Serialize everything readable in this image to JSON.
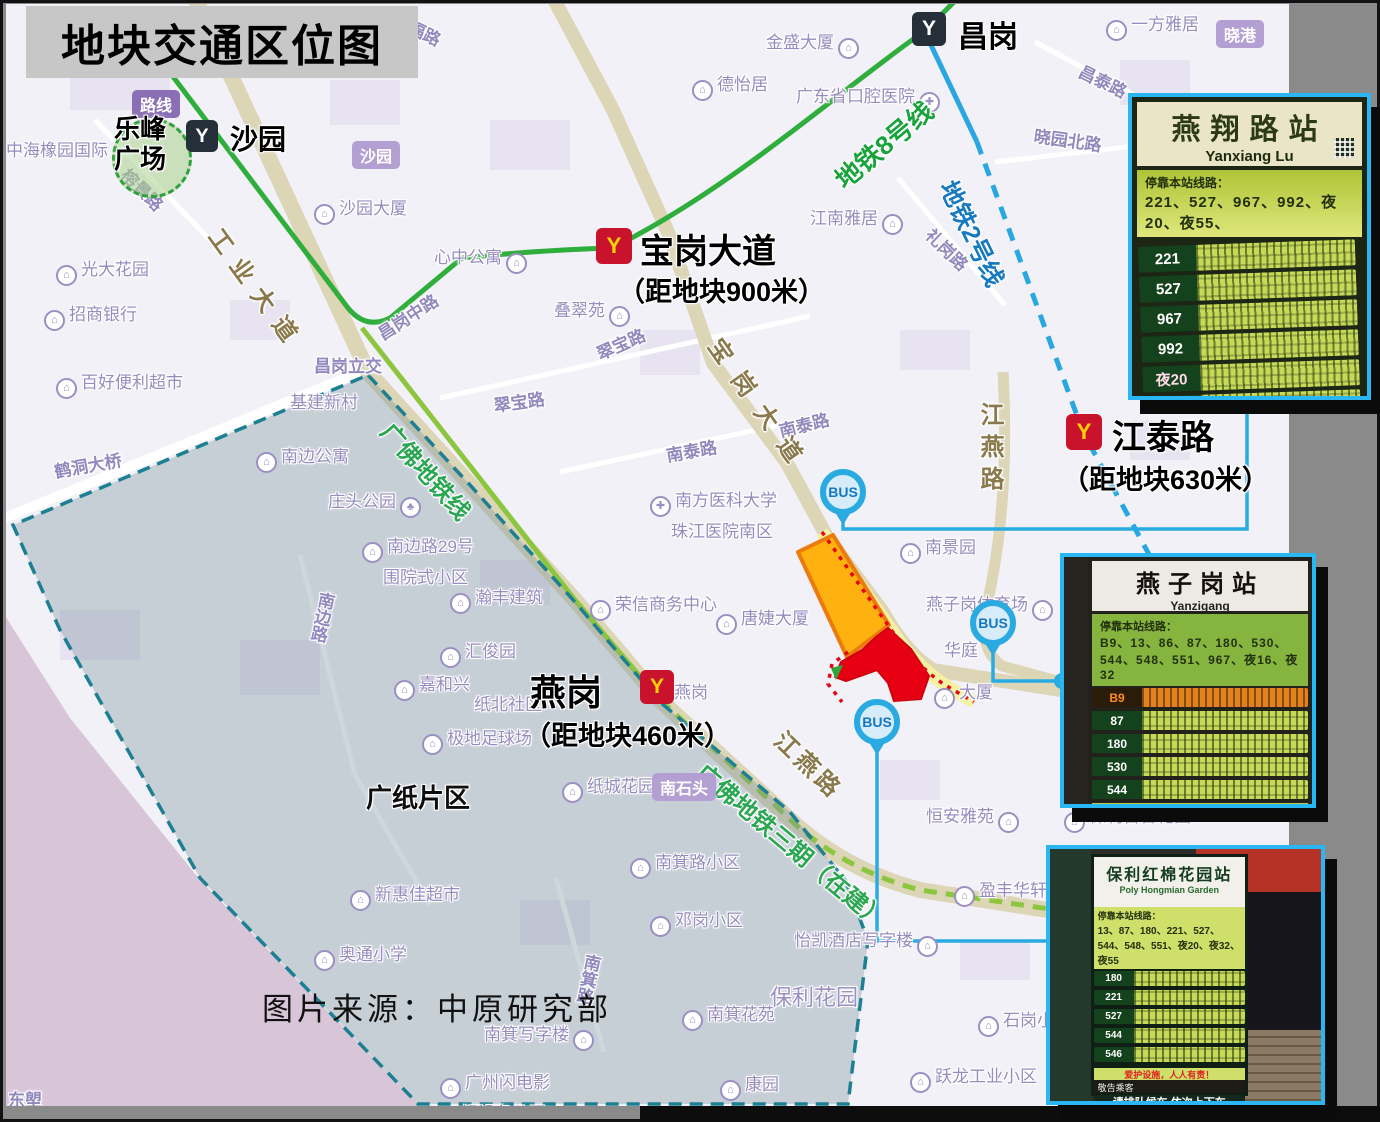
{
  "title": "地块交通区位图",
  "source_note": "图片来源：中原研究部",
  "bus_label": "BUS",
  "area_label": "广纸片区",
  "plaza": {
    "line1": "乐峰",
    "line2": "广场"
  },
  "colors": {
    "accent_blue": "#29abe2",
    "metro_line8_green": "#2fae3c",
    "guangfo_green": "#8cc63e",
    "metro_line2_blue": "#2aa7e0",
    "plot_orange": "#ffb20f",
    "plot_red": "#e60012",
    "region_border_teal": "#1d7f92",
    "road_tan": "#dcd5b6",
    "title_bg": "#c7c7c7"
  },
  "stations": [
    {
      "name": "沙园",
      "style": "dark",
      "x": 186,
      "y": 120,
      "size": 32,
      "label_dx": 44,
      "label_dy": -2,
      "label_size": 28
    },
    {
      "name": "昌岗",
      "style": "dark",
      "x": 912,
      "y": 12,
      "size": 34,
      "label_dx": 46,
      "label_dy": 0,
      "label_size": 30
    },
    {
      "name": "宝岗大道",
      "style": "red",
      "x": 596,
      "y": 228,
      "size": 36,
      "label_dx": 44,
      "label_dy": -4,
      "label_size": 34,
      "dist": "（距地块900米）",
      "dist_dx": 22,
      "dist_dy": 42
    },
    {
      "name": "江泰路",
      "style": "red",
      "x": 1066,
      "y": 414,
      "size": 36,
      "label_dx": 46,
      "label_dy": -4,
      "label_size": 34,
      "dist": "（距地块630米）",
      "dist_dx": -4,
      "dist_dy": 44
    },
    {
      "name": "燕岗",
      "style": "red",
      "x": 640,
      "y": 670,
      "size": 34,
      "label_dx": -110,
      "label_dy": -6,
      "label_size": 36,
      "dist": "（距地块460米）",
      "dist_dx": -116,
      "dist_dy": 44
    }
  ],
  "metro_line_labels": [
    {
      "t": "地铁8号线",
      "x": 826,
      "y": 168,
      "r": -40,
      "cls": "mgreen"
    },
    {
      "t": "地铁2号线",
      "x": 964,
      "y": 174,
      "r": 64,
      "cls": "mblue"
    },
    {
      "t": "广佛地铁线",
      "x": 400,
      "y": 414,
      "r": 48,
      "cls": "mgf"
    },
    {
      "t": "广佛地铁三期（在建）",
      "x": 712,
      "y": 754,
      "r": 40,
      "cls": "mgf"
    }
  ],
  "road_labels": [
    {
      "t": "工业大道",
      "x": 230,
      "y": 220,
      "r": 54,
      "ls": 12
    },
    {
      "t": "宝岗大道",
      "x": 730,
      "y": 330,
      "r": 55,
      "ls": 16
    },
    {
      "t": "江燕路",
      "x": 972,
      "y": 402,
      "v": 1,
      "ls": 8
    },
    {
      "t": "江燕路",
      "x": 792,
      "y": 722,
      "r": 44,
      "ls": 4
    }
  ],
  "street_labels": [
    {
      "t": "绣福路",
      "x": 400,
      "y": 6,
      "r": 26
    },
    {
      "t": "榕景路",
      "x": 134,
      "y": 162,
      "r": 45
    },
    {
      "t": "昌岗中路",
      "x": 372,
      "y": 324,
      "r": -33
    },
    {
      "t": "昌岗立交",
      "x": 314,
      "y": 352,
      "r": 0
    },
    {
      "t": "翠宝路",
      "x": 592,
      "y": 342,
      "r": -24
    },
    {
      "t": "翠宝路",
      "x": 492,
      "y": 392,
      "r": -8
    },
    {
      "t": "南泰路",
      "x": 664,
      "y": 442,
      "r": -10
    },
    {
      "t": "南泰路",
      "x": 776,
      "y": 418,
      "r": -14
    },
    {
      "t": "昌泰路",
      "x": 1086,
      "y": 58,
      "r": 26
    },
    {
      "t": "晓园北路",
      "x": 1036,
      "y": 122,
      "r": 8
    },
    {
      "t": "礼岗路",
      "x": 938,
      "y": 222,
      "r": 44
    },
    {
      "t": "鹤洞大桥",
      "x": 52,
      "y": 458,
      "r": -10
    },
    {
      "t": "南边路",
      "x": 314,
      "y": 592,
      "v": 1,
      "r": 12
    },
    {
      "t": "南箕路",
      "x": 580,
      "y": 954,
      "v": 1,
      "r": 12
    },
    {
      "t": "东塱",
      "x": 8,
      "y": 1086,
      "r": 0
    }
  ],
  "boxed_labels": [
    {
      "t": "路线",
      "x": 132,
      "y": 90,
      "dark": 1
    },
    {
      "t": "沙园",
      "x": 352,
      "y": 141
    },
    {
      "t": "晓港",
      "x": 1216,
      "y": 20
    },
    {
      "t": "南石头",
      "x": 652,
      "y": 773
    }
  ],
  "poi_labels": [
    {
      "t": "中海橡园国际",
      "x": 6,
      "y": 136
    },
    {
      "t": "光大花园",
      "x": 52,
      "y": 255,
      "i": "b",
      "s": "l"
    },
    {
      "t": "招商银行",
      "x": 40,
      "y": 300,
      "i": "b",
      "s": "l"
    },
    {
      "t": "百好便利超市",
      "x": 52,
      "y": 368,
      "i": "b",
      "s": "l"
    },
    {
      "t": "沙园大厦",
      "x": 310,
      "y": 194,
      "i": "b",
      "s": "l"
    },
    {
      "t": "心中公寓",
      "x": 434,
      "y": 243,
      "i": "b",
      "s": "r"
    },
    {
      "t": "德怡居",
      "x": 688,
      "y": 70,
      "i": "b",
      "s": "l"
    },
    {
      "t": "金盛大厦",
      "x": 766,
      "y": 28,
      "i": "b",
      "s": "r"
    },
    {
      "t": "一方雅居",
      "x": 1102,
      "y": 10,
      "i": "b",
      "s": "l"
    },
    {
      "t": "广东省口腔医院",
      "x": 796,
      "y": 82,
      "i": "h",
      "s": "r"
    },
    {
      "t": "江南雅居",
      "x": 810,
      "y": 204,
      "i": "b",
      "s": "r"
    },
    {
      "t": "叠翠苑",
      "x": 554,
      "y": 296,
      "i": "b",
      "s": "r"
    },
    {
      "t": "基建新村",
      "x": 290,
      "y": 388
    },
    {
      "t": "南边公寓",
      "x": 252,
      "y": 442,
      "i": "b",
      "s": "l"
    },
    {
      "t": "庄头公园",
      "x": 328,
      "y": 487,
      "i": "p",
      "s": "r"
    },
    {
      "t": "南边路29号",
      "t2": "围院式小区",
      "x": 358,
      "y": 532,
      "i": "b",
      "s": "l"
    },
    {
      "t": "瀚丰建筑",
      "x": 446,
      "y": 583,
      "i": "b",
      "s": "l"
    },
    {
      "t": "汇俊园",
      "x": 436,
      "y": 637,
      "i": "b",
      "s": "l"
    },
    {
      "t": "嘉和兴",
      "x": 390,
      "y": 670,
      "i": "b",
      "s": "l"
    },
    {
      "t": "极地足球场",
      "x": 418,
      "y": 724,
      "i": "b",
      "s": "l"
    },
    {
      "t": "纸北社区",
      "x": 474,
      "y": 690
    },
    {
      "t": "纸城花园",
      "x": 558,
      "y": 772,
      "i": "b",
      "s": "l"
    },
    {
      "t": "南箕路小区",
      "x": 626,
      "y": 848,
      "i": "b",
      "s": "l"
    },
    {
      "t": "邓岗小区",
      "x": 646,
      "y": 906,
      "i": "b",
      "s": "l"
    },
    {
      "t": "新惠佳超市",
      "x": 346,
      "y": 880,
      "i": "b",
      "s": "l"
    },
    {
      "t": "奥通小学",
      "x": 310,
      "y": 940,
      "i": "b",
      "s": "l"
    },
    {
      "t": "南箕写字楼",
      "x": 484,
      "y": 1020,
      "i": "b",
      "s": "r"
    },
    {
      "t": "广州闪电影",
      "t2": "视设备公司",
      "x": 436,
      "y": 1068,
      "i": "b",
      "s": "l"
    },
    {
      "t": "南箕花苑",
      "x": 678,
      "y": 1000,
      "i": "b",
      "s": "l"
    },
    {
      "t": "康园",
      "x": 716,
      "y": 1070,
      "i": "b",
      "s": "l"
    },
    {
      "t": "保利花园",
      "x": 770,
      "y": 980,
      "big": 1
    },
    {
      "t": "石岗小区",
      "x": 974,
      "y": 1006,
      "i": "b",
      "s": "l"
    },
    {
      "t": "跃龙工业小区",
      "x": 906,
      "y": 1062,
      "i": "b",
      "s": "l"
    },
    {
      "t": "盈丰华轩",
      "x": 950,
      "y": 876,
      "i": "b",
      "s": "l"
    },
    {
      "t": "怡凯酒店写字楼",
      "x": 794,
      "y": 926,
      "i": "b",
      "s": "r"
    },
    {
      "t": "恒安雅苑",
      "x": 926,
      "y": 802,
      "i": "b",
      "s": "r"
    },
    {
      "t": "保利百合花园",
      "x": 1060,
      "y": 802,
      "i": "b",
      "s": "l"
    },
    {
      "t": "荣信商务中心",
      "x": 586,
      "y": 590,
      "i": "b",
      "s": "l"
    },
    {
      "t": "唐婕大厦",
      "x": 712,
      "y": 604,
      "i": "b",
      "s": "l"
    },
    {
      "t": "南方医科大学",
      "t2": "珠江医院南区",
      "x": 646,
      "y": 486,
      "i": "h",
      "s": "l"
    },
    {
      "t": "南景园",
      "x": 896,
      "y": 533,
      "i": "b",
      "s": "l"
    },
    {
      "t": "燕子岗体育场",
      "x": 926,
      "y": 590,
      "i": "b",
      "s": "r"
    },
    {
      "t": "华庭",
      "x": 944,
      "y": 636
    },
    {
      "t": "大厦",
      "x": 930,
      "y": 678,
      "i": "b",
      "s": "l"
    },
    {
      "t": "燕岗",
      "x": 674,
      "y": 678
    },
    {
      "t": "广纸片区",
      "x": 366,
      "y": 778,
      "black": 1
    }
  ],
  "bus_markers": [
    {
      "x": 843,
      "y": 492
    },
    {
      "x": 993,
      "y": 623
    },
    {
      "x": 877,
      "y": 722
    }
  ],
  "photos": [
    {
      "title": "燕翔路站",
      "subtitle": "Yanxiang Lu",
      "stops_header": "停靠本站线路：",
      "stops": "221、527、967、992、夜20、夜55、",
      "rows": [
        {
          "n": "221"
        },
        {
          "n": "527"
        },
        {
          "n": "967"
        },
        {
          "n": "992"
        },
        {
          "n": "夜20",
          "night": 1
        },
        {
          "n": "夜55",
          "night": 1
        }
      ]
    },
    {
      "title": "燕子岗站",
      "subtitle": "Yanzigang",
      "stops_header": "停靠本站线路：",
      "stops": "B9、13、86、87、180、530、544、548、551、967、夜16、夜32",
      "rows": [
        {
          "n": "B9",
          "hl": 1
        },
        {
          "n": "87"
        },
        {
          "n": "180"
        },
        {
          "n": "530"
        },
        {
          "n": "544"
        }
      ],
      "notice": "爱护设施，人人有责！",
      "bottom": "敬告乘客"
    },
    {
      "title": "保利红棉花园站",
      "subtitle": "Poly Hongmian Garden",
      "stops_header": "停靠本站线路：",
      "stops": "13、87、180、221、527、544、548、551、夜20、夜32、夜55",
      "rows": [
        {
          "n": "180"
        },
        {
          "n": "221"
        },
        {
          "n": "527"
        },
        {
          "n": "544"
        },
        {
          "n": "546"
        }
      ],
      "notice": "爱护设施，人人有责！",
      "bottom": "敬告乘客",
      "footer": "请排队候车 依次上下车"
    }
  ]
}
